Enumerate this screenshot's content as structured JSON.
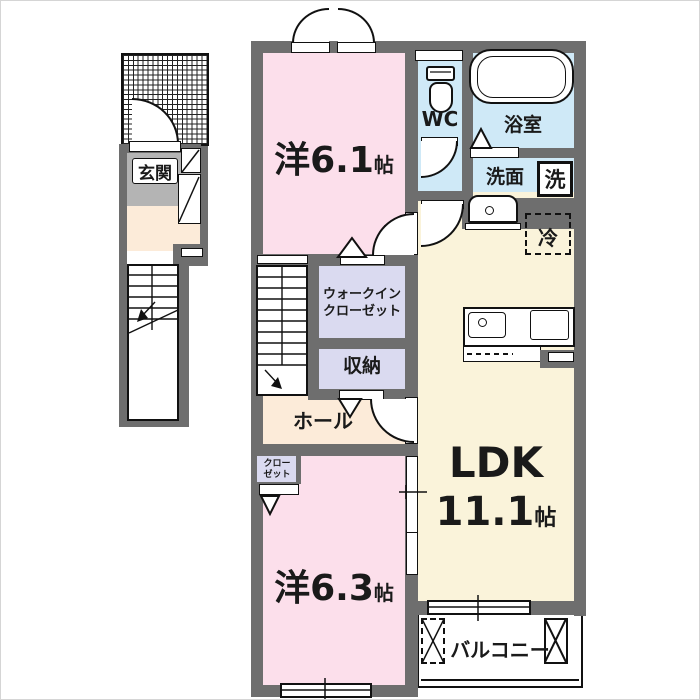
{
  "floorplan": {
    "rooms": {
      "bedroom1": {
        "name": "洋6.1",
        "unit": "帖"
      },
      "bedroom2": {
        "name": "洋6.3",
        "unit": "帖"
      },
      "ldk": {
        "name": "LDK",
        "size": "11.1",
        "unit": "帖"
      },
      "wc": {
        "name": "WC"
      },
      "bathroom": {
        "name": "浴室"
      },
      "washroom": {
        "name": "洗面"
      },
      "washer": {
        "name": "洗"
      },
      "fridge": {
        "name": "冷"
      },
      "walkin_closet": {
        "line1": "ウォークイン",
        "line2": "クローゼット"
      },
      "storage": {
        "name": "収納"
      },
      "hall": {
        "name": "ホール"
      },
      "closet": {
        "line1": "クロー",
        "line2": "ゼット"
      },
      "entrance": {
        "name": "玄関"
      },
      "balcony": {
        "name": "バルコニー"
      }
    },
    "colors": {
      "wall": "#6e6e6e",
      "bedroom_pink": "#fcdfeb",
      "ldk_cream": "#faf3da",
      "hall_peach": "#fcebd9",
      "wet_area_blue": "#cfe9f7",
      "closet_lavender": "#dadaf0",
      "entrance_gray": "#b4b4b4"
    }
  }
}
